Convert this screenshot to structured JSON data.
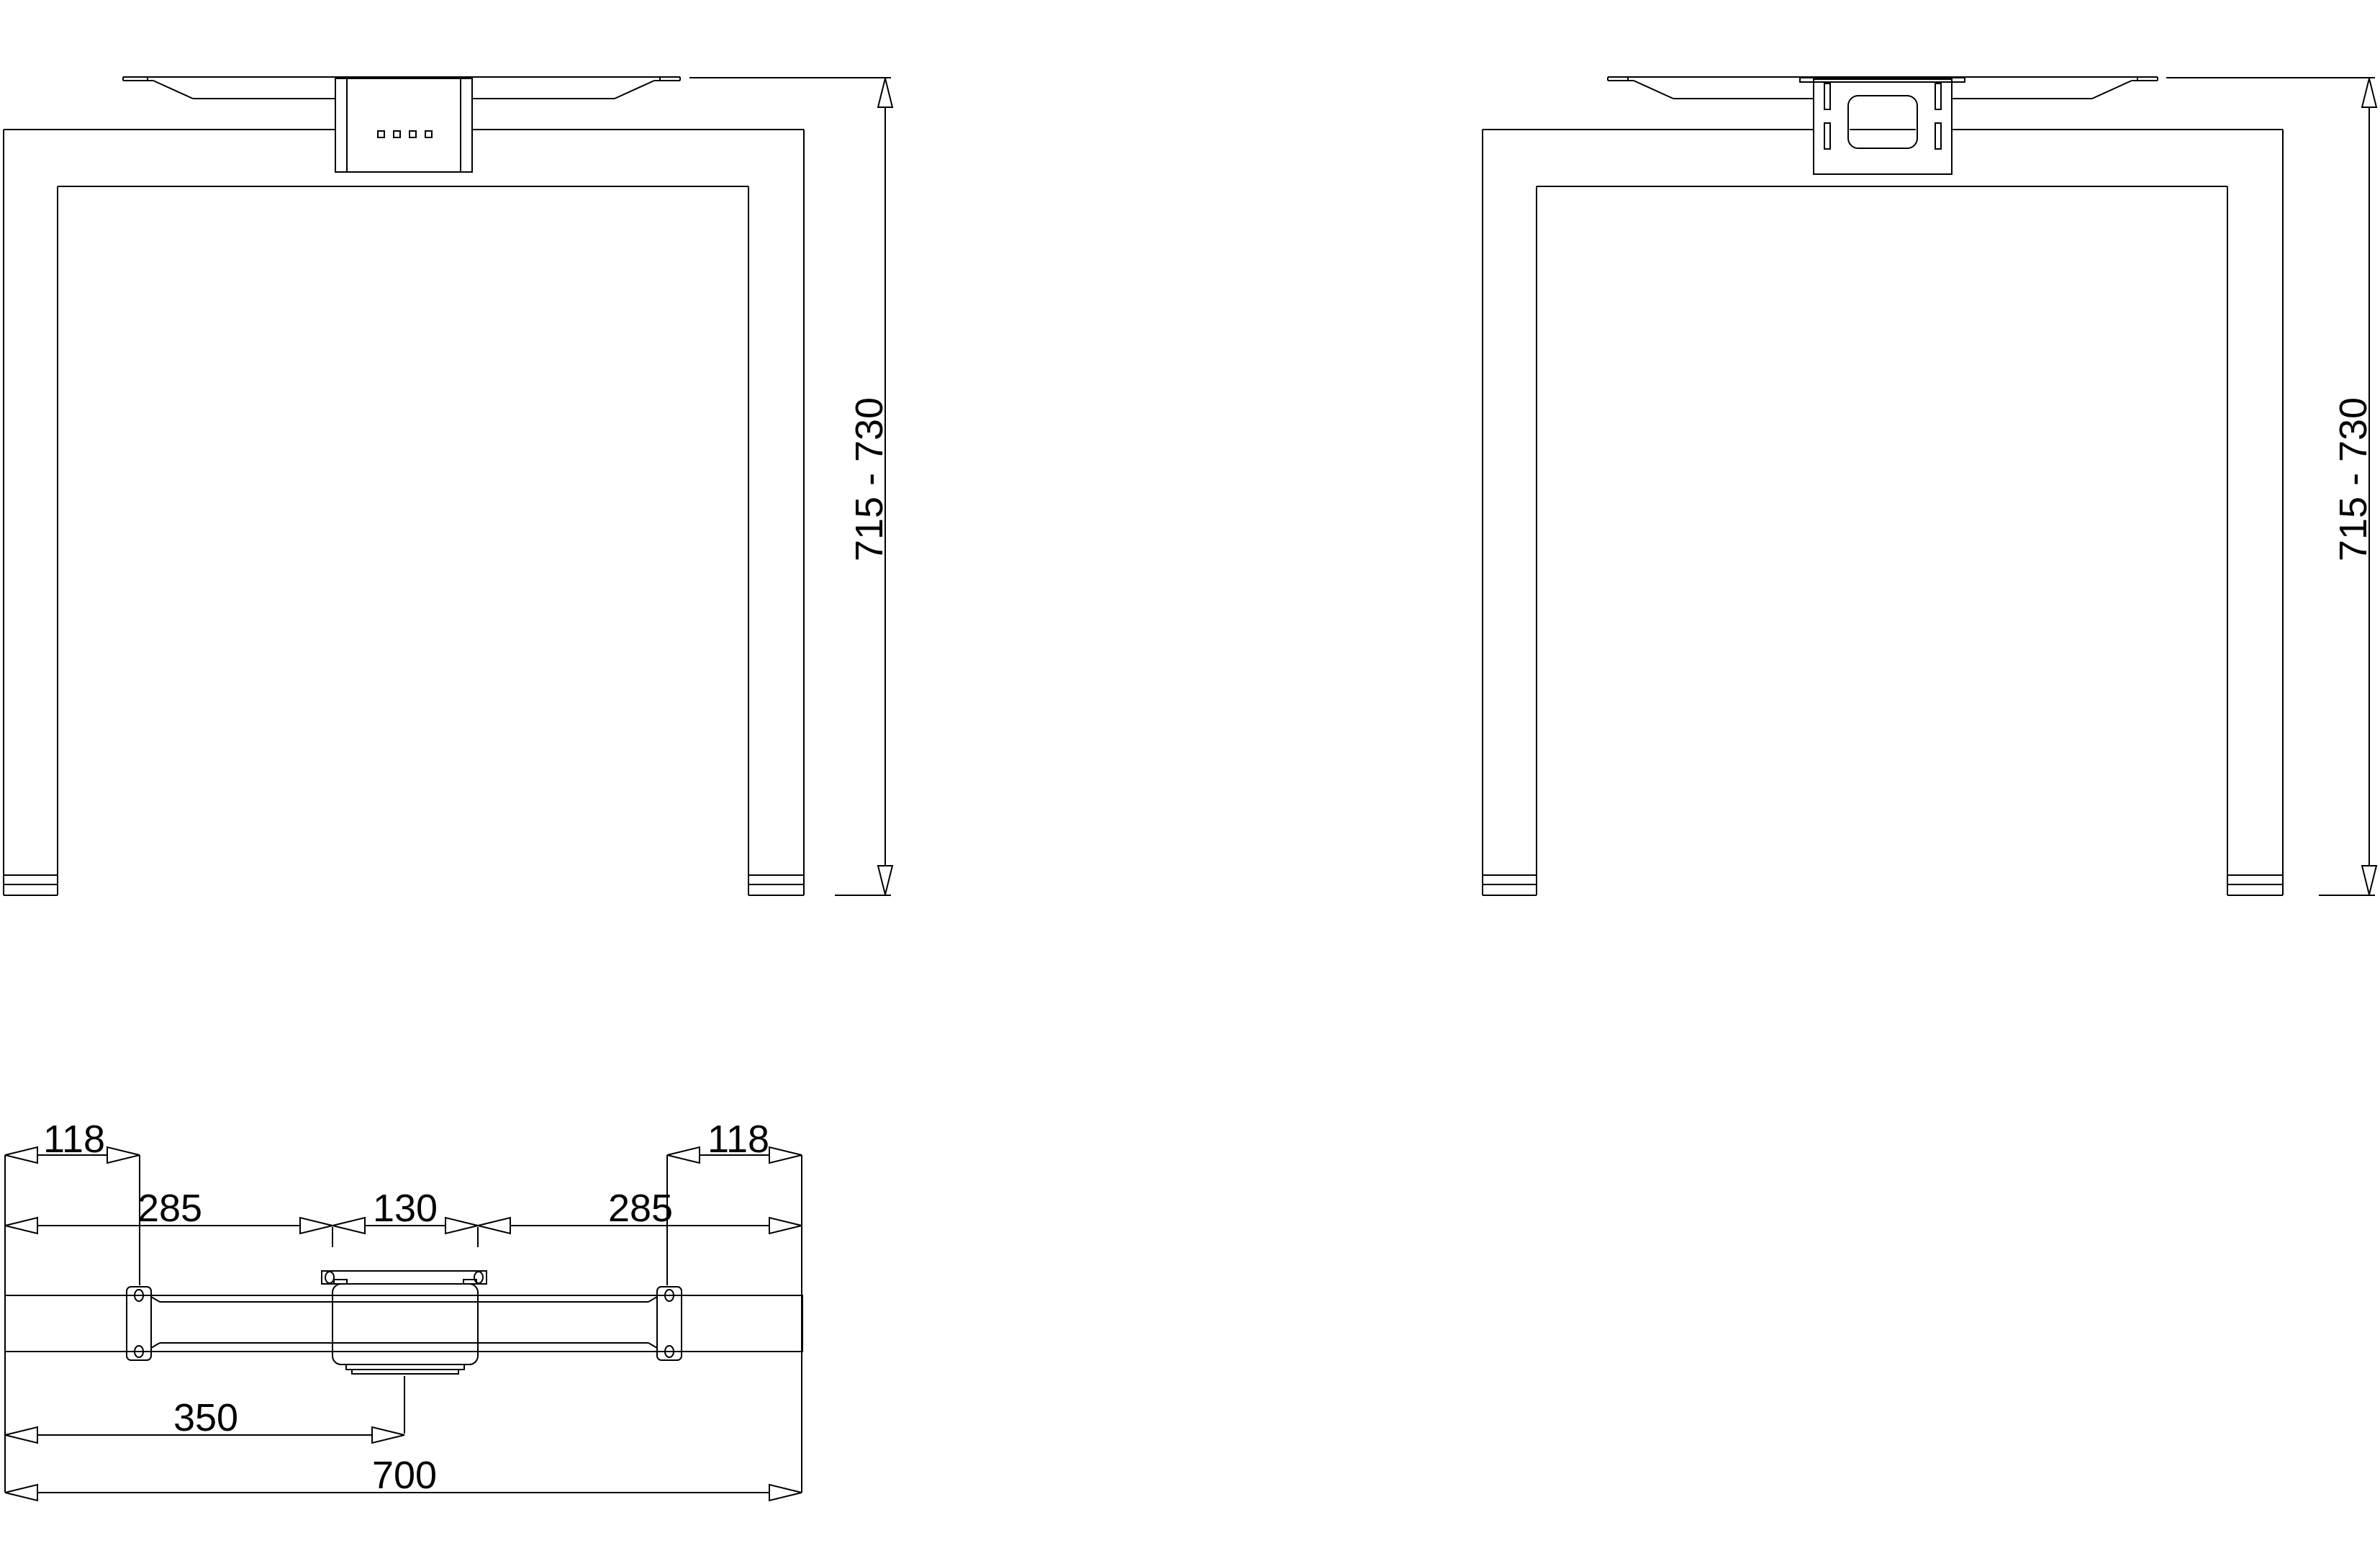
{
  "views": {
    "front": {
      "height_label": "715 - 730"
    },
    "rear": {
      "height_label": "715 - 730"
    },
    "top": {
      "left_offset": "118",
      "right_offset": "118",
      "left_span": "285",
      "center_span": "130",
      "right_span": "285",
      "half_length": "350",
      "total_length": "700"
    }
  },
  "colors": {
    "line": "#000000",
    "background": "#ffffff"
  }
}
